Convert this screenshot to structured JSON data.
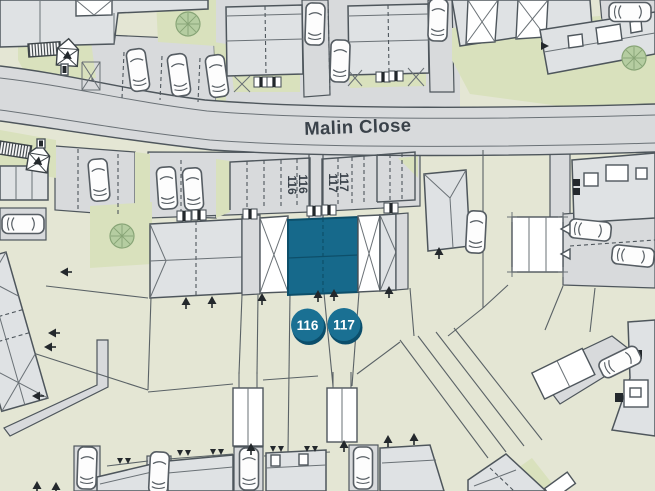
{
  "map": {
    "street_label": "Malin Close",
    "plot_markers": [
      {
        "id": "116",
        "label": "116"
      },
      {
        "id": "117",
        "label": "117"
      }
    ],
    "parking_bay_labels": {
      "plot116": [
        "116",
        "116"
      ],
      "plot117": [
        "117",
        "117"
      ]
    },
    "colors": {
      "highlight_fill": "#16698b",
      "highlight_stroke": "#0d4f6a",
      "marker_fill": "#1a7093",
      "marker_shadow": "#0b4e6b",
      "marker_text": "#ffffff",
      "road": "#d8dadc",
      "building": "#dfe2e4",
      "green_verge": "#d9e1bd",
      "plot_green": "#e4e6d4",
      "tree": "#b5cda1",
      "outline": "#4e565c",
      "label_text": "#3a424a"
    }
  }
}
